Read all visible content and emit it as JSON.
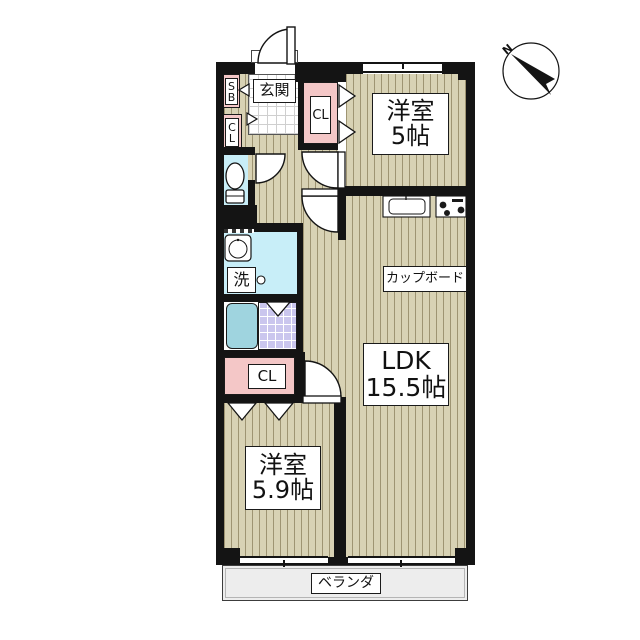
{
  "compass": {
    "north_label": "N"
  },
  "entrance": {
    "label": "玄関",
    "shoe_box_label": "SB"
  },
  "closets": {
    "hall_label": "CL",
    "bedroom1_label": "CL",
    "bedroom2_label": "CL"
  },
  "washroom": {
    "washer_label": "洗"
  },
  "rooms": {
    "bedroom1": {
      "name": "洋室",
      "size": "5帖"
    },
    "bedroom2": {
      "name": "洋室",
      "size": "5.9帖"
    },
    "ldk": {
      "name": "LDK",
      "size": "15.5帖"
    },
    "cupboard_label": "カップボード",
    "veranda_label": "ベランダ"
  },
  "colors": {
    "wall": "#141414",
    "floor_beige": "#d8d2b4",
    "closet_pink": "#f4c7c7",
    "water_cyan": "#c8eef8",
    "bathtub_teal": "#9fd4df",
    "bath_tile_purple": "#cac6ee",
    "veranda_gray": "#ededed"
  }
}
